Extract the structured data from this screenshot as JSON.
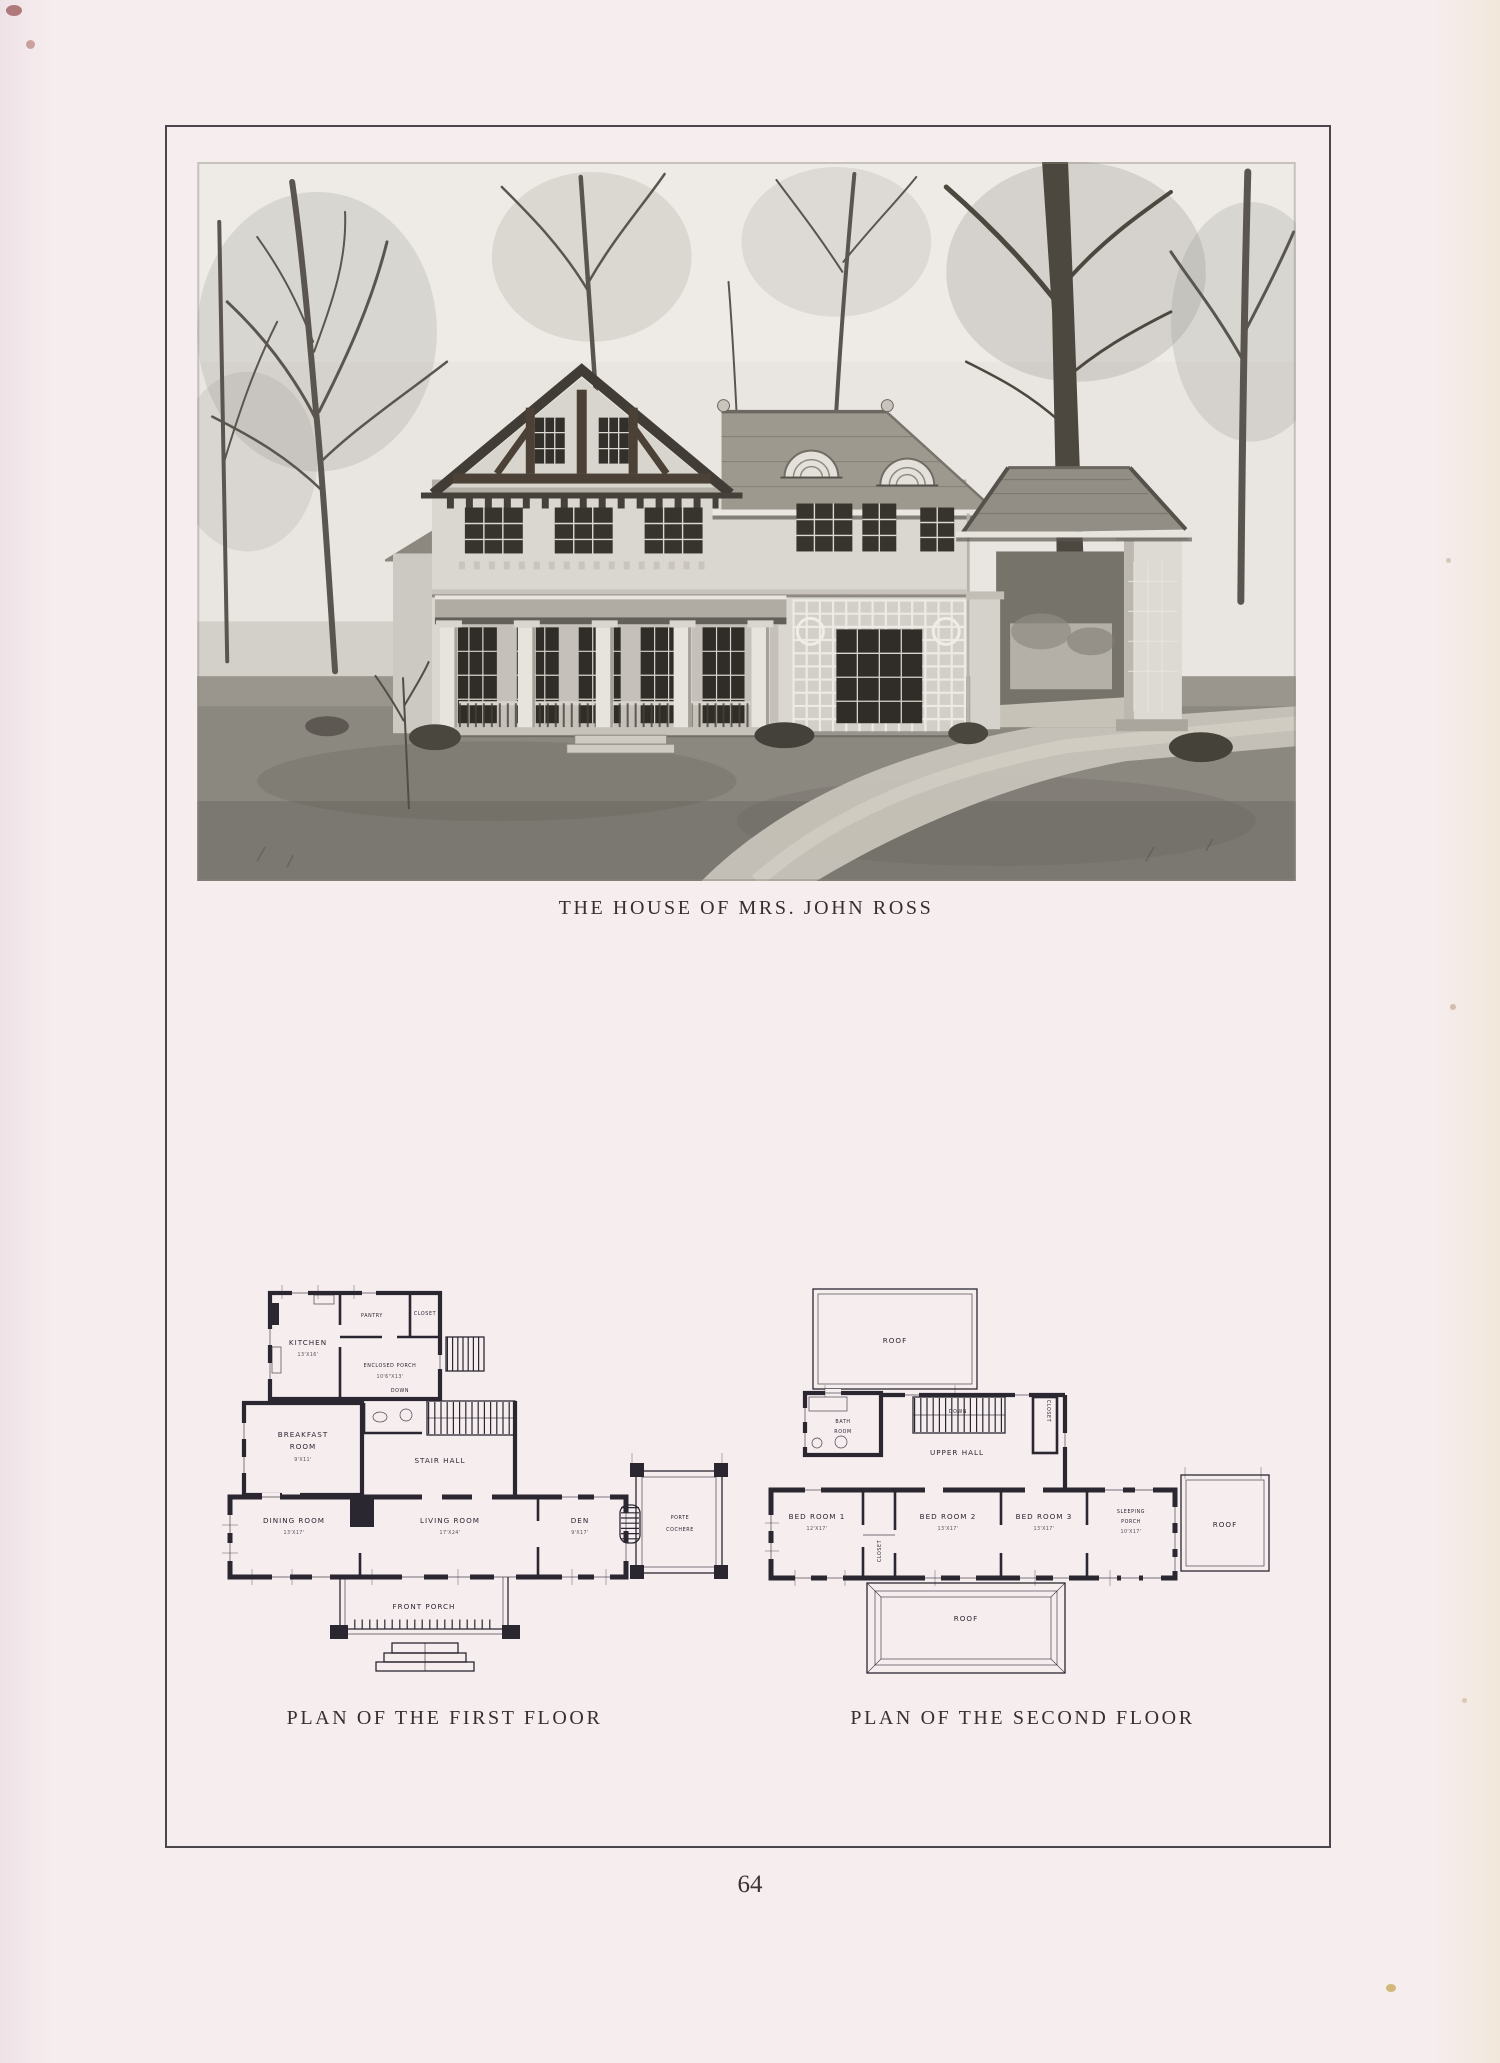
{
  "page": {
    "number": "64"
  },
  "captions": {
    "photo": "THE HOUSE OF MRS. JOHN ROSS",
    "first_floor": "PLAN OF THE FIRST FLOOR",
    "second_floor": "PLAN OF THE SECOND FLOOR"
  },
  "first_floor": {
    "kitchen": "KITCHEN",
    "kitchen_dim": "13'X16'",
    "pantry": "PANTRY",
    "closet": "CLOSET",
    "enclosed_porch": "ENCLOSED PORCH",
    "enclosed_porch_dim": "10'6\"X13'",
    "breakfast_1": "BREAKFAST",
    "breakfast_2": "ROOM",
    "breakfast_dim": "9'X11'",
    "stair_hall": "STAIR HALL",
    "down": "DOWN",
    "dining": "DINING ROOM",
    "dining_dim": "13'X17'",
    "living": "LIVING ROOM",
    "living_dim": "17'X24'",
    "den": "DEN",
    "den_dim": "9'X17'",
    "porte_1": "PORTE",
    "porte_2": "COCHERE",
    "front_porch": "FRONT PORCH"
  },
  "second_floor": {
    "roof": "ROOF",
    "bath_1": "BATH",
    "bath_2": "ROOM",
    "upper_hall": "UPPER HALL",
    "down": "DOWN",
    "closet": "CLOSET",
    "bed1": "BED ROOM 1",
    "bed1_dim": "12'X17'",
    "bed2": "BED ROOM 2",
    "bed2_dim": "13'X17'",
    "bed3": "BED ROOM 3",
    "bed3_dim": "13'X17'",
    "sleeping_1": "SLEEPING",
    "sleeping_2": "PORCH",
    "sleeping_dim": "10'X17'"
  },
  "colors": {
    "paper": "#f6edef",
    "ink": "#2b2731",
    "frame": "#4b464c"
  }
}
